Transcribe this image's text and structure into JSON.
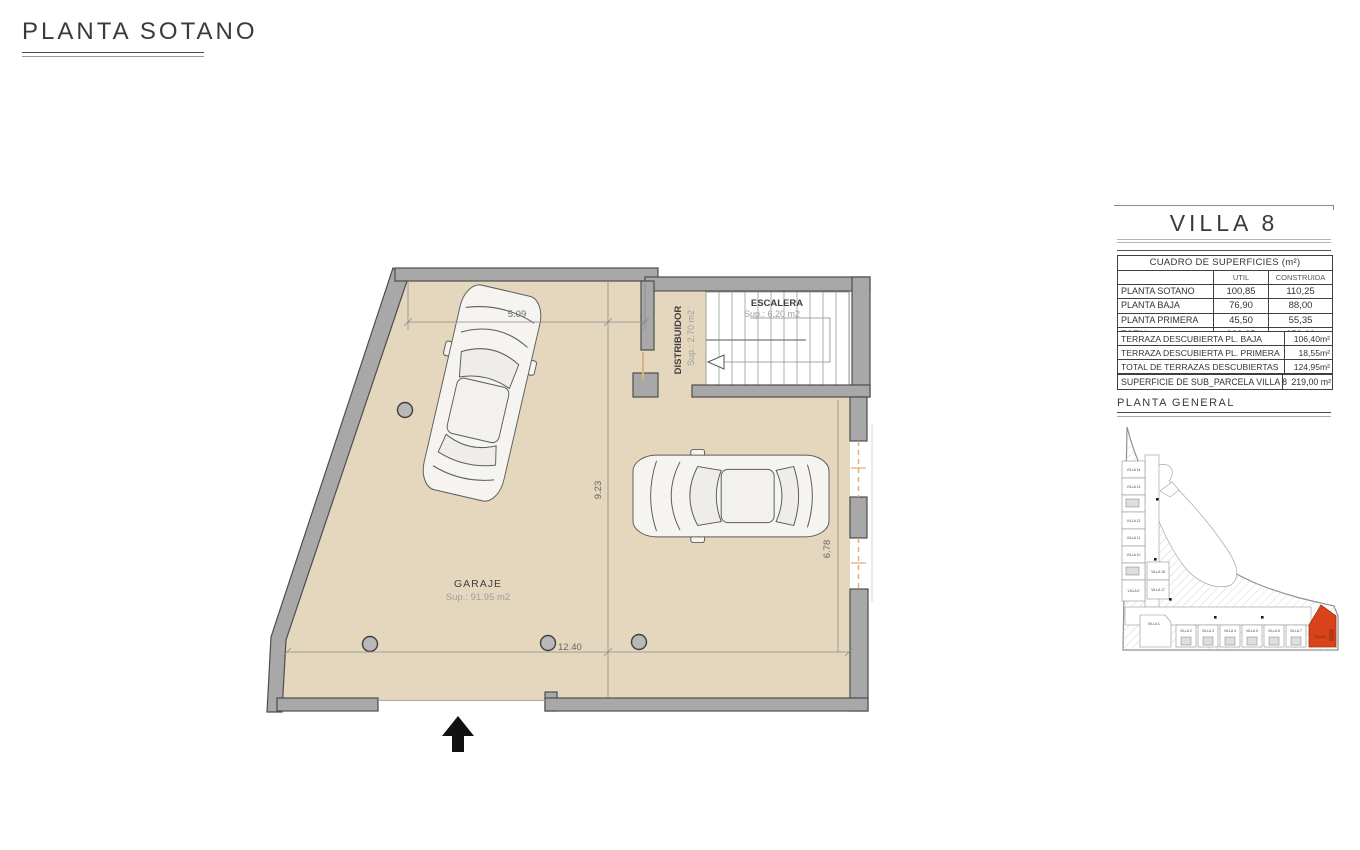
{
  "page": {
    "title": "PLANTA SOTANO"
  },
  "panel": {
    "title": "VILLA 8",
    "superficies_table": {
      "title": "CUADRO DE SUPERFICIES (m²)",
      "col_headers": {
        "util": "UTIL",
        "construida": "CONSTRUIDA"
      },
      "rows": [
        {
          "label": "PLANTA SOTANO",
          "util": "100,85",
          "construida": "110,25"
        },
        {
          "label": "PLANTA BAJA",
          "util": "76,90",
          "construida": "88,00"
        },
        {
          "label": "PLANTA PRIMERA",
          "util": "45,50",
          "construida": "55,35"
        },
        {
          "label": "TOTAL",
          "util": "223,25",
          "construida": "253,60"
        }
      ]
    },
    "terrazas_table": {
      "rows": [
        {
          "label": "TERRAZA DESCUBIERTA PL. BAJA",
          "value": "106,40m²"
        },
        {
          "label": "TERRAZA DESCUBIERTA PL. PRIMERA",
          "value": "18,55m²"
        },
        {
          "label": "TOTAL DE TERRAZAS DESCUBIERTAS",
          "value": "124,95m²"
        }
      ]
    },
    "parcela_row": {
      "label": "SUPERFICIE DE SUB_PARCELA VILLA 8",
      "value": "219,00 m²"
    },
    "site_plan": {
      "title": "PLANTA GENERAL",
      "highlight_villa": "VILLA 8",
      "highlight_color": "#d8431c",
      "left_villas": [
        "VILLA 14",
        "VILLA 13",
        "VILLA 12",
        "VILLA 11",
        "VILLA 10",
        "VILLA 9"
      ],
      "inner_villas": [
        "VILLA 16",
        "VILLA 17"
      ],
      "bottom_villas": [
        "VILLA 1",
        "VILLA 2",
        "VILLA 3",
        "VILLA 4",
        "VILLA 5",
        "VILLA 6",
        "VILLA 7"
      ]
    }
  },
  "plan": {
    "rooms": {
      "garaje": {
        "name": "GARAJE",
        "area": "Sup.: 91.95  m2"
      },
      "escalera": {
        "name": "ESCALERA",
        "area": "Sup.: 6.20   m2"
      },
      "distribuidor": {
        "name": "DISTRIBUIDOR",
        "area": "Sup.: 2.70   m2"
      }
    },
    "dimensions": {
      "top": "5.09",
      "middle_vertical": "9.23",
      "bottom": "12.40",
      "right_vertical": "6.78"
    },
    "colors": {
      "floor": "#e4d7bd",
      "wall": "#a8a8a8",
      "wall_edge": "#4d4d4d",
      "opening": "#ddb07c"
    }
  }
}
